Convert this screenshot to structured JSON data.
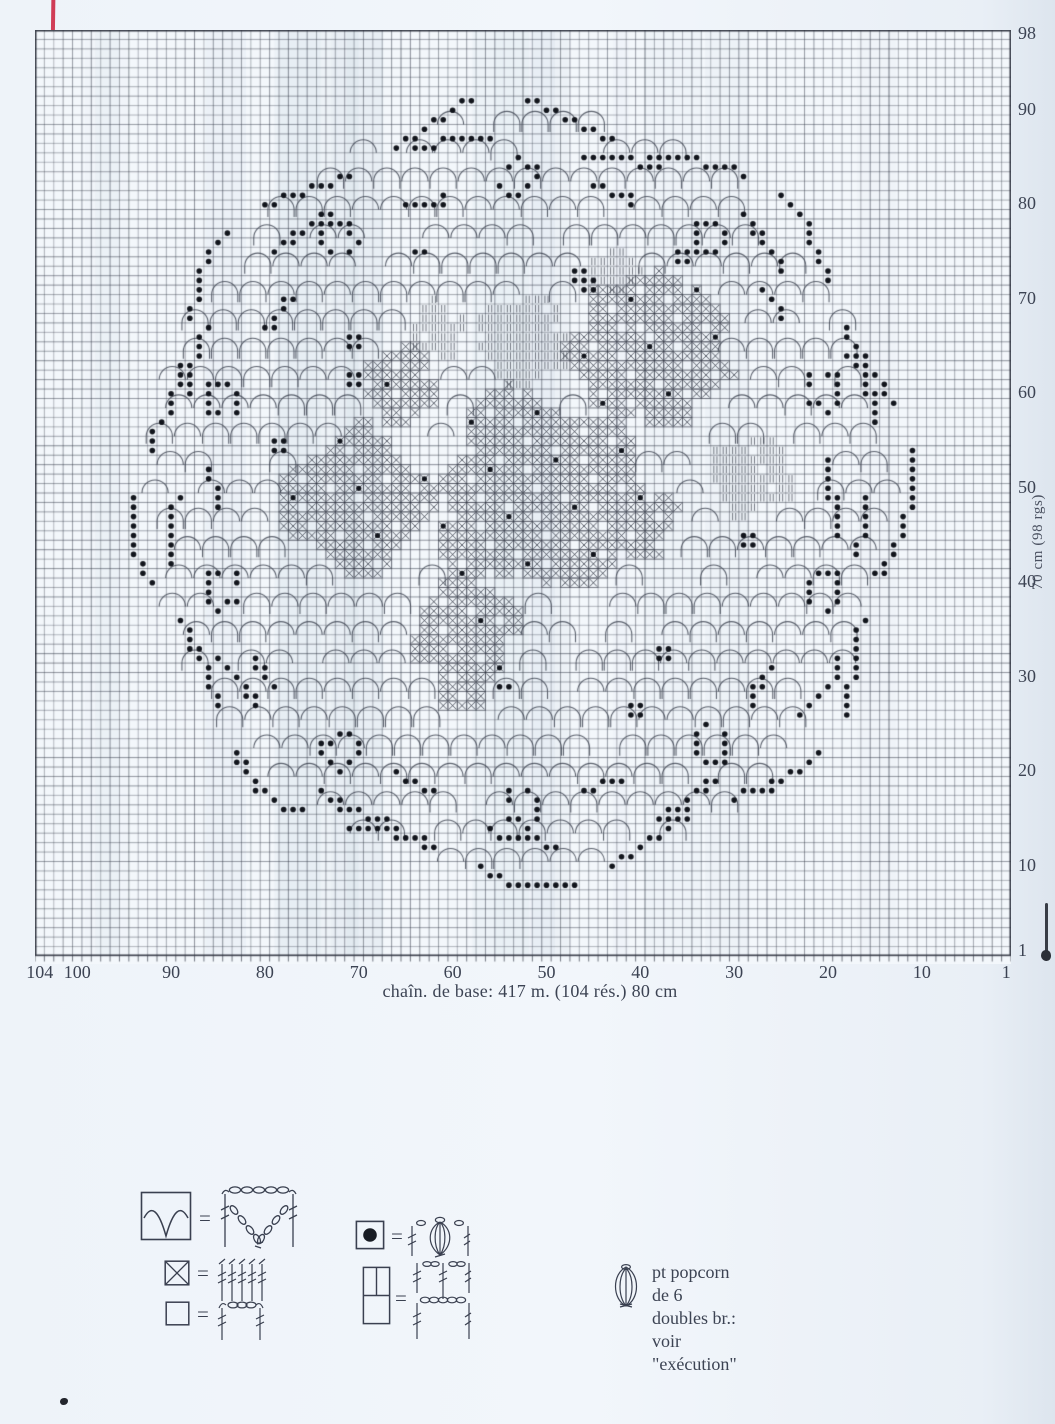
{
  "chart": {
    "columns": 104,
    "rows": 98,
    "bottom_axis_labels": [
      "104",
      "100",
      "90",
      "80",
      "70",
      "60",
      "50",
      "40",
      "30",
      "20",
      "10",
      "1"
    ],
    "bottom_axis_values": [
      104,
      100,
      90,
      80,
      70,
      60,
      50,
      40,
      30,
      20,
      10,
      1
    ],
    "right_axis_labels": [
      "98",
      "90",
      "80",
      "70",
      "60",
      "50",
      "40",
      "30",
      "20",
      "10",
      "1"
    ],
    "right_axis_values": [
      98,
      90,
      80,
      70,
      60,
      50,
      40,
      30,
      20,
      10,
      1
    ],
    "caption": "chaîn. de base: 417 m. (104 rés.) 80 cm",
    "side_note": "70 cm (98 rgs)"
  },
  "legend": {
    "equals_sign": "=",
    "items": [
      {
        "symbol": "scallop-v-cell"
      },
      {
        "symbol": "crossed-x-cell"
      },
      {
        "symbol": "empty-mesh-cell"
      },
      {
        "symbol": "popcorn-dot-cell"
      },
      {
        "symbol": "double-height-cell"
      }
    ],
    "note_line1": "pt popcorn de 6 doubles br.:",
    "note_line2": "voir \"exécution\""
  },
  "colors": {
    "ink": "#3a4050",
    "dot": "#12151c",
    "paper": "#f3f7fb",
    "red_line": "#d8506b"
  }
}
